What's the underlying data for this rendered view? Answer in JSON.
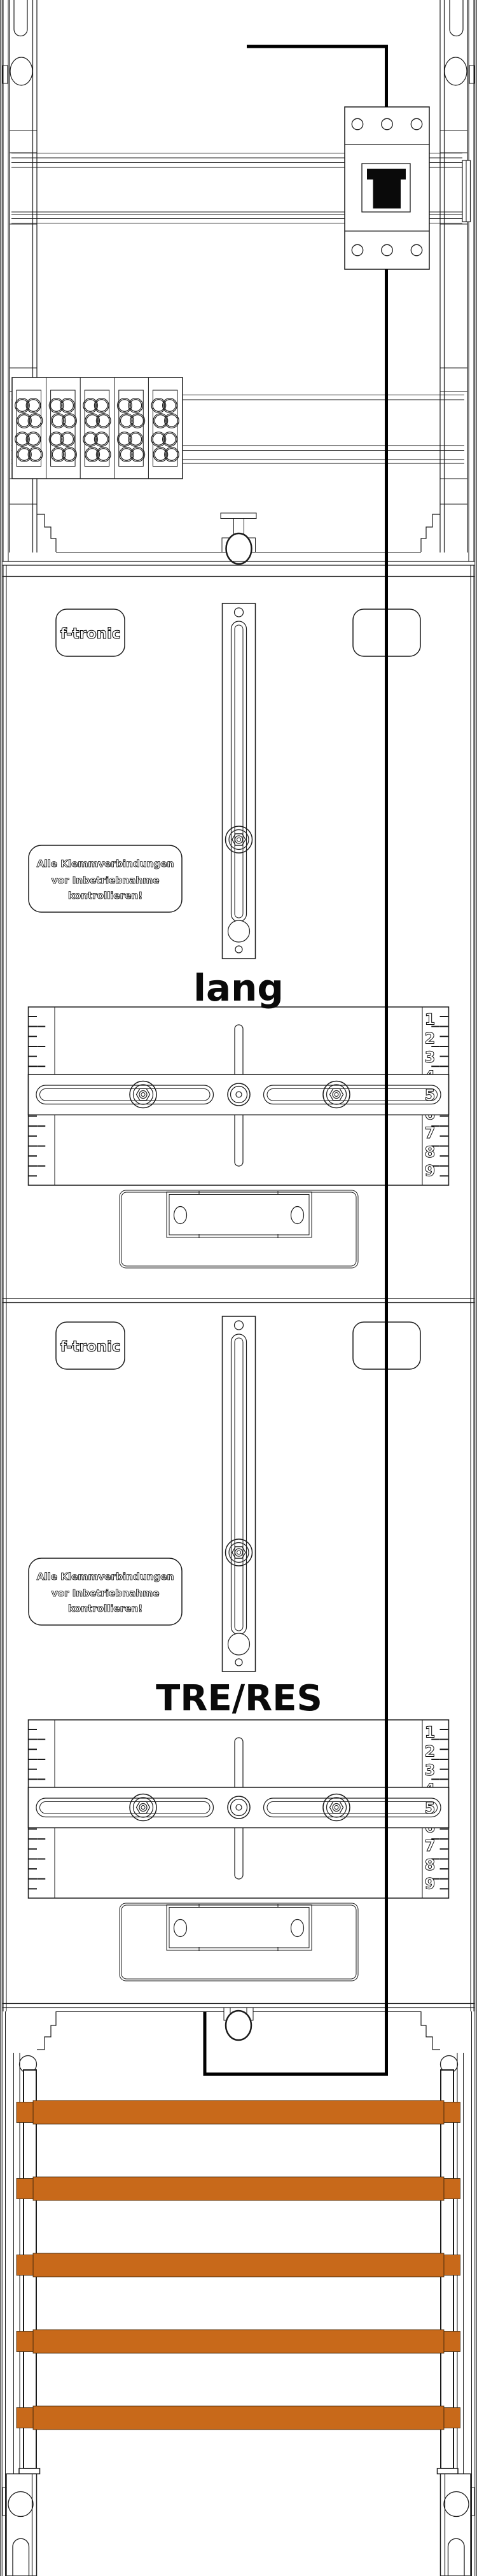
{
  "drawing": {
    "brand": {
      "logo": "f-tronic"
    },
    "warning_plate": {
      "lines": [
        "Alle Klemmverbindungen",
        "vor Inbetriebnahme",
        "kontrollieren!"
      ]
    },
    "fields": [
      {
        "label": "lang"
      },
      {
        "label": "TRE/RES"
      }
    ],
    "ruler": {
      "numbers": [
        "1",
        "2",
        "3",
        "4",
        "5",
        "6",
        "7",
        "8",
        "9"
      ]
    },
    "colors": {
      "busbar": "#c8691a",
      "line": "#1a1a1a",
      "wire": "#000000",
      "background": "#ffffff"
    }
  }
}
